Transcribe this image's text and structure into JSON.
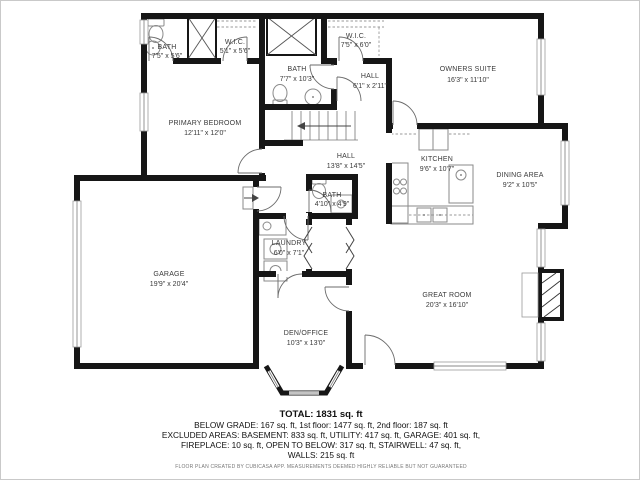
{
  "page": {
    "background": "#ffffff",
    "border_color": "#c9c9c9",
    "wall_color": "#161616",
    "label_color": "#3a3a3a"
  },
  "plan": {
    "rooms": [
      {
        "id": "bath-top-left",
        "name": "BATH",
        "dims": "7'5\" x 5'6\""
      },
      {
        "id": "wic-small",
        "name": "W.I.C.",
        "dims": "5'1\" x 5'6\""
      },
      {
        "id": "wic-owners",
        "name": "W.I.C.",
        "dims": "7'5\" x 6'0\""
      },
      {
        "id": "bath-upper",
        "name": "BATH",
        "dims": "7'7\" x 10'3\""
      },
      {
        "id": "hall-small",
        "name": "HALL",
        "dims": "6'1\" x 2'11\""
      },
      {
        "id": "owners-suite",
        "name": "OWNERS SUITE",
        "dims": "16'3\" x 11'10\""
      },
      {
        "id": "primary-bedroom",
        "name": "PRIMARY BEDROOM",
        "dims": "12'11\" x 12'0\""
      },
      {
        "id": "hall-main",
        "name": "HALL",
        "dims": "13'8\" x 14'5\""
      },
      {
        "id": "kitchen",
        "name": "KITCHEN",
        "dims": "9'6\" x 10'7\""
      },
      {
        "id": "dining-area",
        "name": "DINING AREA",
        "dims": "9'2\" x 10'5\""
      },
      {
        "id": "bath-half",
        "name": "BATH",
        "dims": "4'10\" x 4'9\""
      },
      {
        "id": "laundry",
        "name": "LAUNDRY",
        "dims": "6'0\" x 7'1\""
      },
      {
        "id": "garage",
        "name": "GARAGE",
        "dims": "19'9\" x 20'4\""
      },
      {
        "id": "great-room",
        "name": "GREAT ROOM",
        "dims": "20'3\" x 16'10\""
      },
      {
        "id": "den-office",
        "name": "DEN/OFFICE",
        "dims": "10'3\" x 13'0\""
      }
    ]
  },
  "summary": {
    "total": "TOTAL: 1831 sq. ft",
    "line1": "BELOW GRADE: 167 sq. ft, 1st floor: 1477 sq. ft, 2nd floor: 187 sq. ft",
    "line2": "EXCLUDED AREAS: BASEMENT: 833 sq. ft, UTILITY: 417 sq. ft, GARAGE: 401 sq. ft,",
    "line3": "FIREPLACE: 10 sq. ft, OPEN TO BELOW: 317 sq. ft, STAIRWELL: 47 sq. ft,",
    "line4": "WALLS: 215 sq. ft",
    "disclaimer": "FLOOR PLAN CREATED BY CUBICASA APP. MEASUREMENTS DEEMED HIGHLY RELIABLE BUT NOT GUARANTEED"
  }
}
